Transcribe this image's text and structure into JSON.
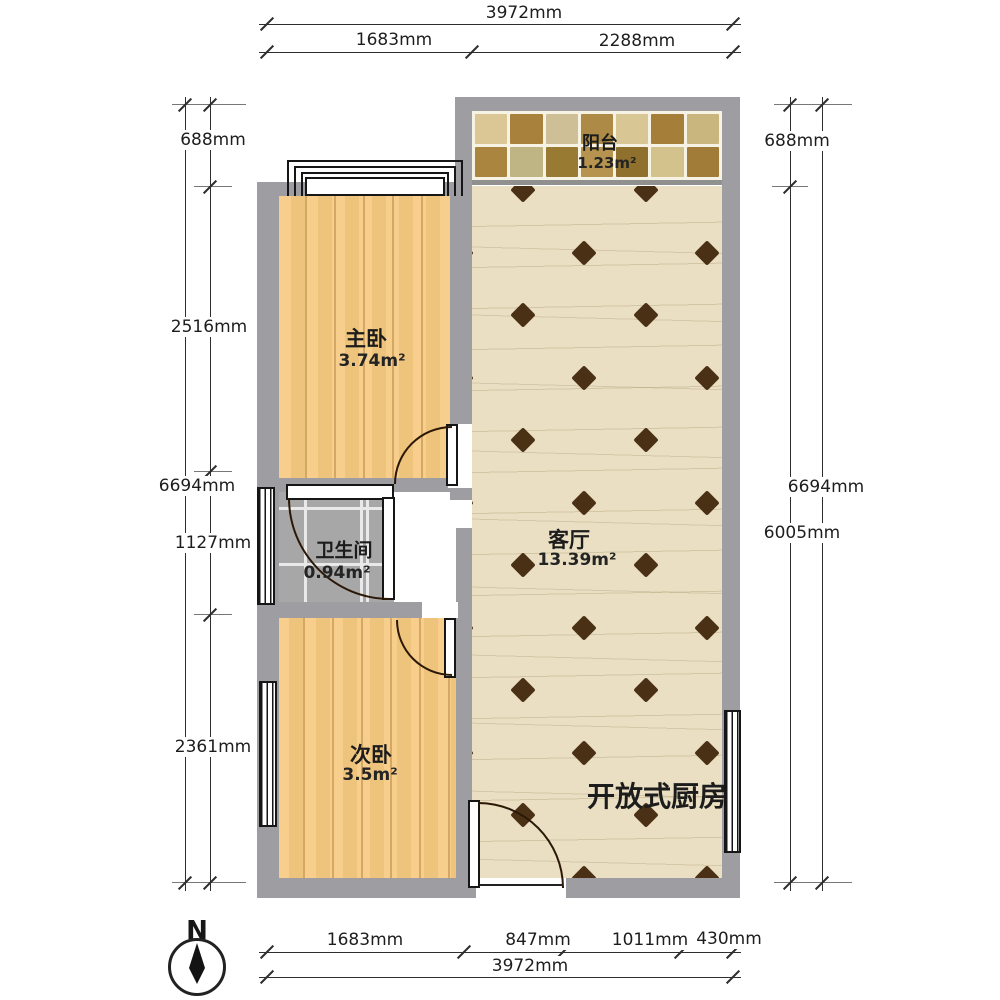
{
  "rooms": {
    "balcony": {
      "name": "阳台",
      "area": "1.23m²"
    },
    "master": {
      "name": "主卧",
      "area": "3.74m²"
    },
    "bathroom": {
      "name": "卫生间",
      "area": "0.94m²"
    },
    "living": {
      "name": "客厅",
      "area": "13.39m²"
    },
    "second": {
      "name": "次卧",
      "area": "3.5m²"
    },
    "kitchen_label": "开放式厨房"
  },
  "dimensions": {
    "top": {
      "total": "3972mm",
      "segments": [
        "1683mm",
        "2288mm"
      ]
    },
    "bottom": {
      "total": "3972mm",
      "segments": [
        "1683mm",
        "847mm",
        "1011mm",
        "430mm"
      ]
    },
    "left": {
      "total": "6694mm",
      "segments": [
        "688mm",
        "2516mm",
        "1127mm",
        "2361mm"
      ]
    },
    "right": {
      "total": "6694mm",
      "segments": [
        "688mm",
        "6005mm"
      ]
    }
  },
  "compass": {
    "north_label": "N"
  },
  "colors": {
    "wall": "#9e9ea2",
    "wood": "#f6c97f",
    "woodline": "#ab712880",
    "floor": "#eadfc2",
    "vein": "#a6946855",
    "diamond": "#4a3116",
    "door": "#2b1807",
    "frame": "#161616",
    "dim": "#2e2e2e",
    "tile_gray": "#a7a7a7",
    "grout": "#e9e9e9",
    "mosaic_grout": "#f6f2e4",
    "divider": "#90908f",
    "mosaic_palette": [
      "#dbc795",
      "#a8813c",
      "#cfbf97",
      "#ad8a45",
      "#d8c795",
      "#a57f39",
      "#c9b67e",
      "#a9853f",
      "#bfb584",
      "#997a33",
      "#b6944f",
      "#8f702d",
      "#d3c28c",
      "#a07c38"
    ]
  }
}
